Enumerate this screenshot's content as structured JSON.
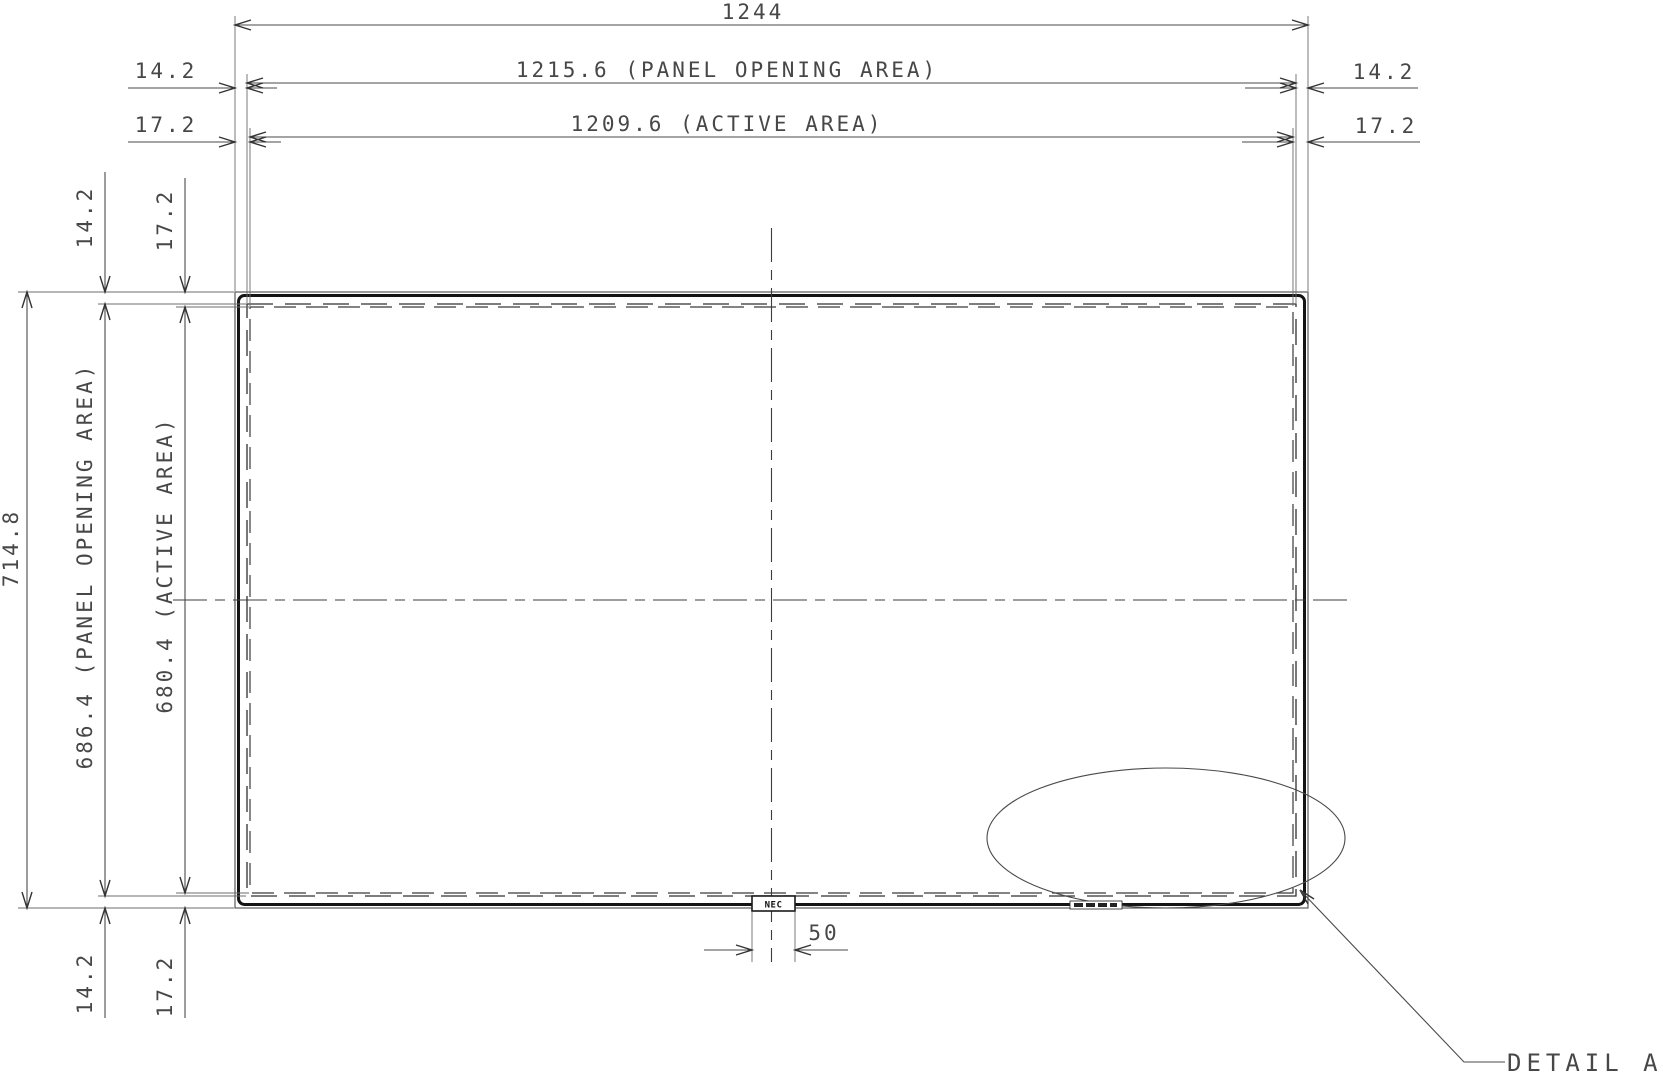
{
  "drawing": {
    "background": "#ffffff",
    "line_color": "#2a2a2a",
    "top_dimensions": {
      "overall_width": "1244",
      "panel_opening_width": "1215.6 (PANEL OPENING AREA)",
      "active_width": "1209.6 (ACTIVE AREA)",
      "left_margin_small": "14.2",
      "left_margin_large": "17.2",
      "right_margin_small": "14.2",
      "right_margin_large": "17.2"
    },
    "side_dimensions": {
      "overall_height": "714.8",
      "panel_opening_height": "686.4 (PANEL OPENING AREA)",
      "active_height": "680.4 (ACTIVE AREA)",
      "top_margin_small": "14.2",
      "top_margin_large": "17.2",
      "bottom_margin_small": "14.2",
      "bottom_margin_large": "17.2"
    },
    "bottom_dimensions": {
      "logo_width": "50"
    },
    "logo_text": "NEC",
    "detail_callout": "DETAIL A"
  }
}
